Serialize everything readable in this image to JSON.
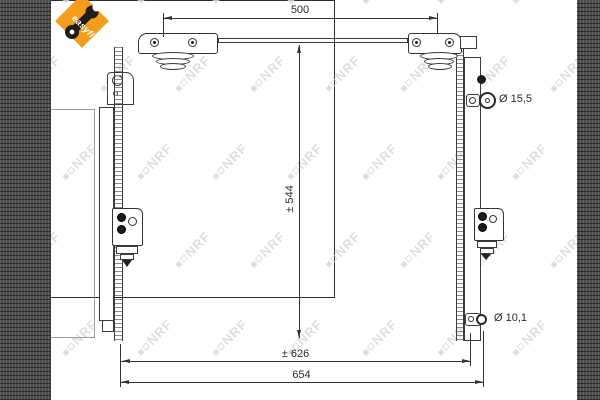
{
  "logo": {
    "text": "easyfit"
  },
  "watermark": {
    "text": "NRF"
  },
  "dimensions": {
    "top_mount_spacing": "500",
    "height": "± 544",
    "width_inner": "± 626",
    "width_overall": "654"
  },
  "fittings": {
    "upper": "Ø 15,5",
    "lower": "Ø 10,1"
  },
  "colors": {
    "accent": "#F49D1D",
    "line": "#333333",
    "core_fill": "#4a4a4a",
    "watermark": "#d9d9d9"
  }
}
